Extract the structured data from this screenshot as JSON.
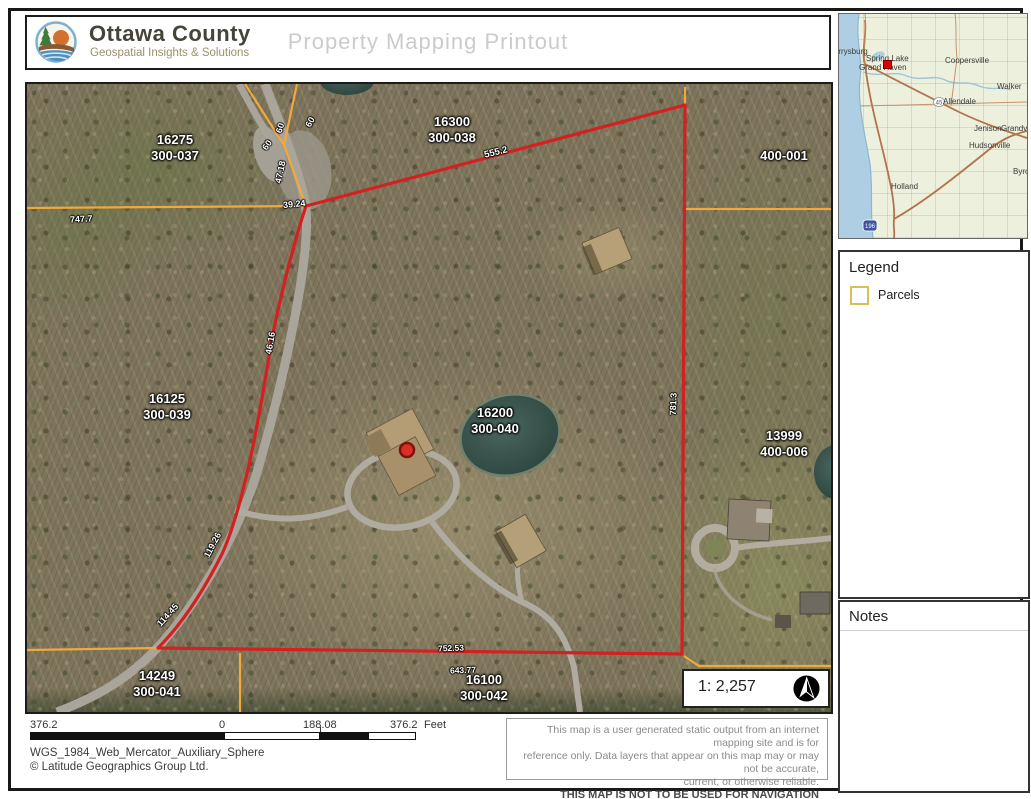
{
  "header": {
    "org_name": "Ottawa County",
    "org_tagline": "Geospatial Insights & Solutions",
    "title": "Property Mapping Printout"
  },
  "map": {
    "parcel_labels": [
      {
        "apn": "16275",
        "code": "300-037"
      },
      {
        "apn": "16300",
        "code": "300-038"
      },
      {
        "apn": "400-001",
        "code": ""
      },
      {
        "apn": "16125",
        "code": "300-039"
      },
      {
        "apn": "16200",
        "code": "300-040"
      },
      {
        "apn": "13999",
        "code": "400-006"
      },
      {
        "apn": "14249",
        "code": "300-041"
      },
      {
        "apn": "16100",
        "code": "300-042"
      }
    ],
    "dimension_labels": [
      {
        "text": "747.7"
      },
      {
        "text": "555.2"
      },
      {
        "text": "39.24"
      },
      {
        "text": "47.18"
      },
      {
        "text": "60"
      },
      {
        "text": "60"
      },
      {
        "text": "60"
      },
      {
        "text": "46.16"
      },
      {
        "text": "119.26"
      },
      {
        "text": "114.45"
      },
      {
        "text": "781.3"
      },
      {
        "text": "752.53"
      },
      {
        "text": "643.77"
      }
    ],
    "colors": {
      "subject_boundary": "#d42020",
      "parcel_lines": "#f2a93b",
      "subject_marker": "#d93025"
    }
  },
  "inset": {
    "cities": [
      {
        "name": "Ferrysburg"
      },
      {
        "name": "Spring Lake"
      },
      {
        "name": "Grand Haven"
      },
      {
        "name": "Coopersville"
      },
      {
        "name": "Walker"
      },
      {
        "name": "Allendale"
      },
      {
        "name": "Jenison"
      },
      {
        "name": "Grandville"
      },
      {
        "name": "Hudsonville"
      },
      {
        "name": "Holland"
      },
      {
        "name": "Byron Center"
      }
    ],
    "route_shield_45": "45",
    "route_shield_196": "196",
    "marker_color": "#dd0000"
  },
  "legend": {
    "title": "Legend",
    "items": [
      {
        "label": "Parcels",
        "swatch_color": "#d9c054"
      }
    ]
  },
  "notes": {
    "title": "Notes"
  },
  "scale_indicator": {
    "ratio": "1: 2,257"
  },
  "scale_bar": {
    "far_left": "376.2",
    "zero": "0",
    "middle": "188.08",
    "right": "376.2",
    "unit": "Feet"
  },
  "footer": {
    "projection": "WGS_1984_Web_Mercator_Auxiliary_Sphere",
    "copyright": "© Latitude Geographics Group Ltd.",
    "disclaimer_line1": "This map is a user generated static output from an internet mapping site and is for",
    "disclaimer_line2": "reference only. Data layers that appear on this map may or may not be accurate,",
    "disclaimer_line3": "current, or otherwise reliable.",
    "disclaimer_line4": "THIS MAP IS NOT TO BE USED FOR NAVIGATION"
  }
}
